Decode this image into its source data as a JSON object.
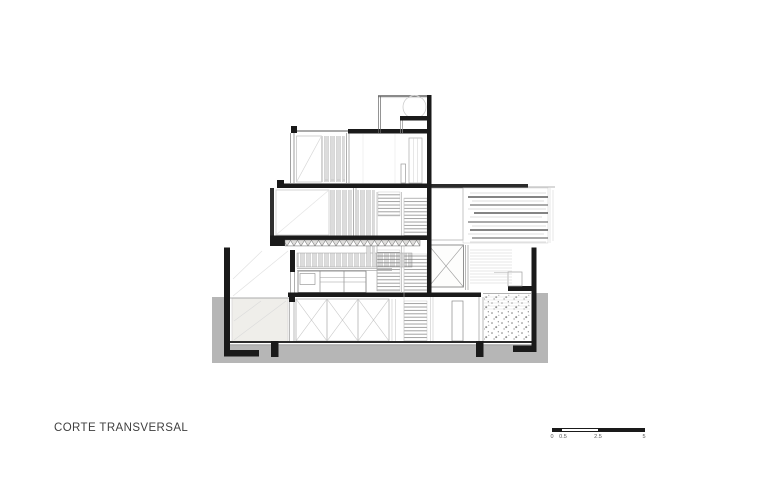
{
  "title": {
    "label": "CORTE TRANSVERSAL"
  },
  "scale_bar": {
    "labels": [
      "0",
      "0.5",
      "2.5",
      "5"
    ]
  },
  "colors": {
    "ink": "#1a1a1a",
    "mid": "#888888",
    "light": "#c8c8c8",
    "ground": "#b6b6b6",
    "panel": "#efeeea",
    "paper": "#ffffff",
    "text": "#3f3f3f"
  }
}
